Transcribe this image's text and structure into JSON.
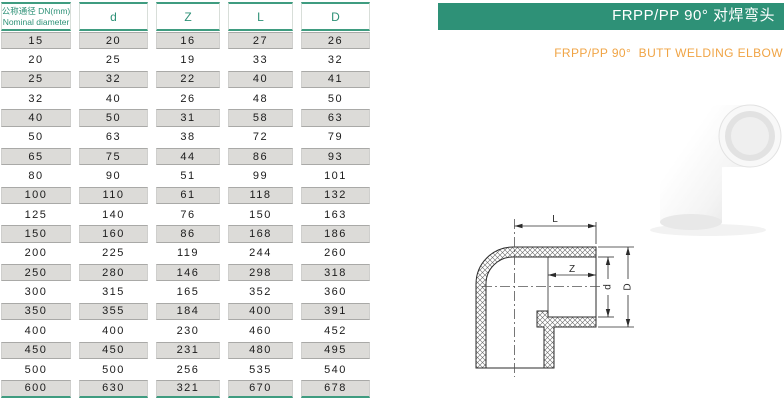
{
  "header": {
    "title_zh": "FRPP/PP 90° 对焊弯头",
    "title_en": "FRPP/PP 90°  BUTT WELDING ELBOW"
  },
  "table": {
    "col1_label_zh": "公称通径 DN(mm)",
    "col1_label_en": "Nominal diameter",
    "columns": [
      "d",
      "Z",
      "L",
      "D"
    ],
    "rows": [
      [
        "15",
        "20",
        "16",
        "27",
        "26"
      ],
      [
        "20",
        "25",
        "19",
        "33",
        "32"
      ],
      [
        "25",
        "32",
        "22",
        "40",
        "41"
      ],
      [
        "32",
        "40",
        "26",
        "48",
        "50"
      ],
      [
        "40",
        "50",
        "31",
        "58",
        "63"
      ],
      [
        "50",
        "63",
        "38",
        "72",
        "79"
      ],
      [
        "65",
        "75",
        "44",
        "86",
        "93"
      ],
      [
        "80",
        "90",
        "51",
        "99",
        "101"
      ],
      [
        "100",
        "110",
        "61",
        "118",
        "132"
      ],
      [
        "125",
        "140",
        "76",
        "150",
        "163"
      ],
      [
        "150",
        "160",
        "86",
        "168",
        "186"
      ],
      [
        "200",
        "225",
        "119",
        "244",
        "260"
      ],
      [
        "250",
        "280",
        "146",
        "298",
        "318"
      ],
      [
        "300",
        "315",
        "165",
        "352",
        "360"
      ],
      [
        "350",
        "355",
        "184",
        "400",
        "391"
      ],
      [
        "400",
        "400",
        "230",
        "460",
        "452"
      ],
      [
        "450",
        "450",
        "231",
        "480",
        "495"
      ],
      [
        "500",
        "500",
        "256",
        "535",
        "540"
      ],
      [
        "600",
        "630",
        "321",
        "670",
        "678"
      ]
    ]
  },
  "diagram": {
    "labels": {
      "L": "L",
      "Z": "Z",
      "d": "d",
      "D": "D"
    }
  },
  "colors": {
    "accent_green": "#2e9177",
    "accent_orange": "#f0a445",
    "row_gray": "#dcdbd8"
  }
}
